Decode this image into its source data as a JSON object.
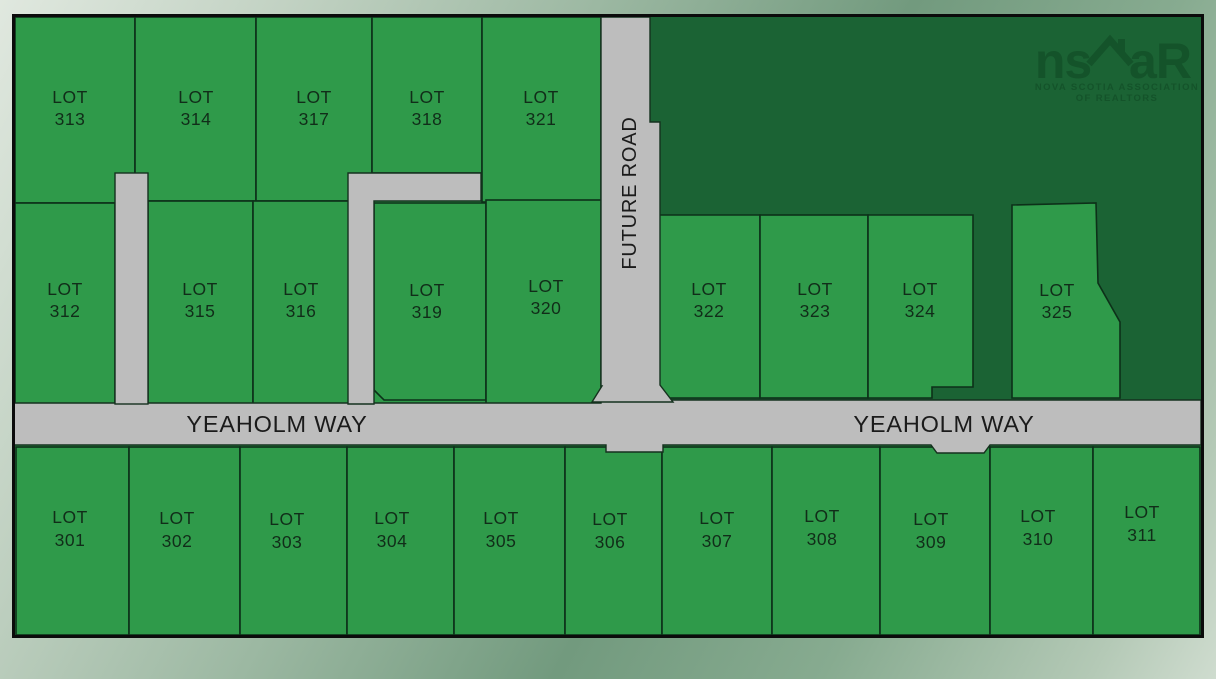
{
  "map_title": "Yeaholm Way subdivision plat map",
  "labels": {
    "lot_word": "LOT"
  },
  "lots": {
    "l301": "301",
    "l302": "302",
    "l303": "303",
    "l304": "304",
    "l305": "305",
    "l306": "306",
    "l307": "307",
    "l308": "308",
    "l309": "309",
    "l310": "310",
    "l311": "311",
    "l312": "312",
    "l313": "313",
    "l314": "314",
    "l315": "315",
    "l316": "316",
    "l317": "317",
    "l318": "318",
    "l319": "319",
    "l320": "320",
    "l321": "321",
    "l322": "322",
    "l323": "323",
    "l324": "324",
    "l325": "325"
  },
  "roads": {
    "yeaholm_west": "YEAHOLM WAY",
    "yeaholm_east": "YEAHOLM WAY",
    "future_road": "FUTURE ROAD"
  },
  "logo": {
    "brand_left": "ns",
    "brand_right": "aR",
    "tagline_line1": "NOVA SCOTIA ASSOCIATION",
    "tagline_line2": "OF REALTORS"
  },
  "colors": {
    "lot_green": "#2f9a4a",
    "dark_green": "#1b6334",
    "road_gray": "#bdbdbd",
    "boundary_line": "#0d3019",
    "lot_text": "#112d19",
    "road_text": "#1b1b1b",
    "logo_green": "#14532a",
    "map_border": "#0b0b0b"
  }
}
